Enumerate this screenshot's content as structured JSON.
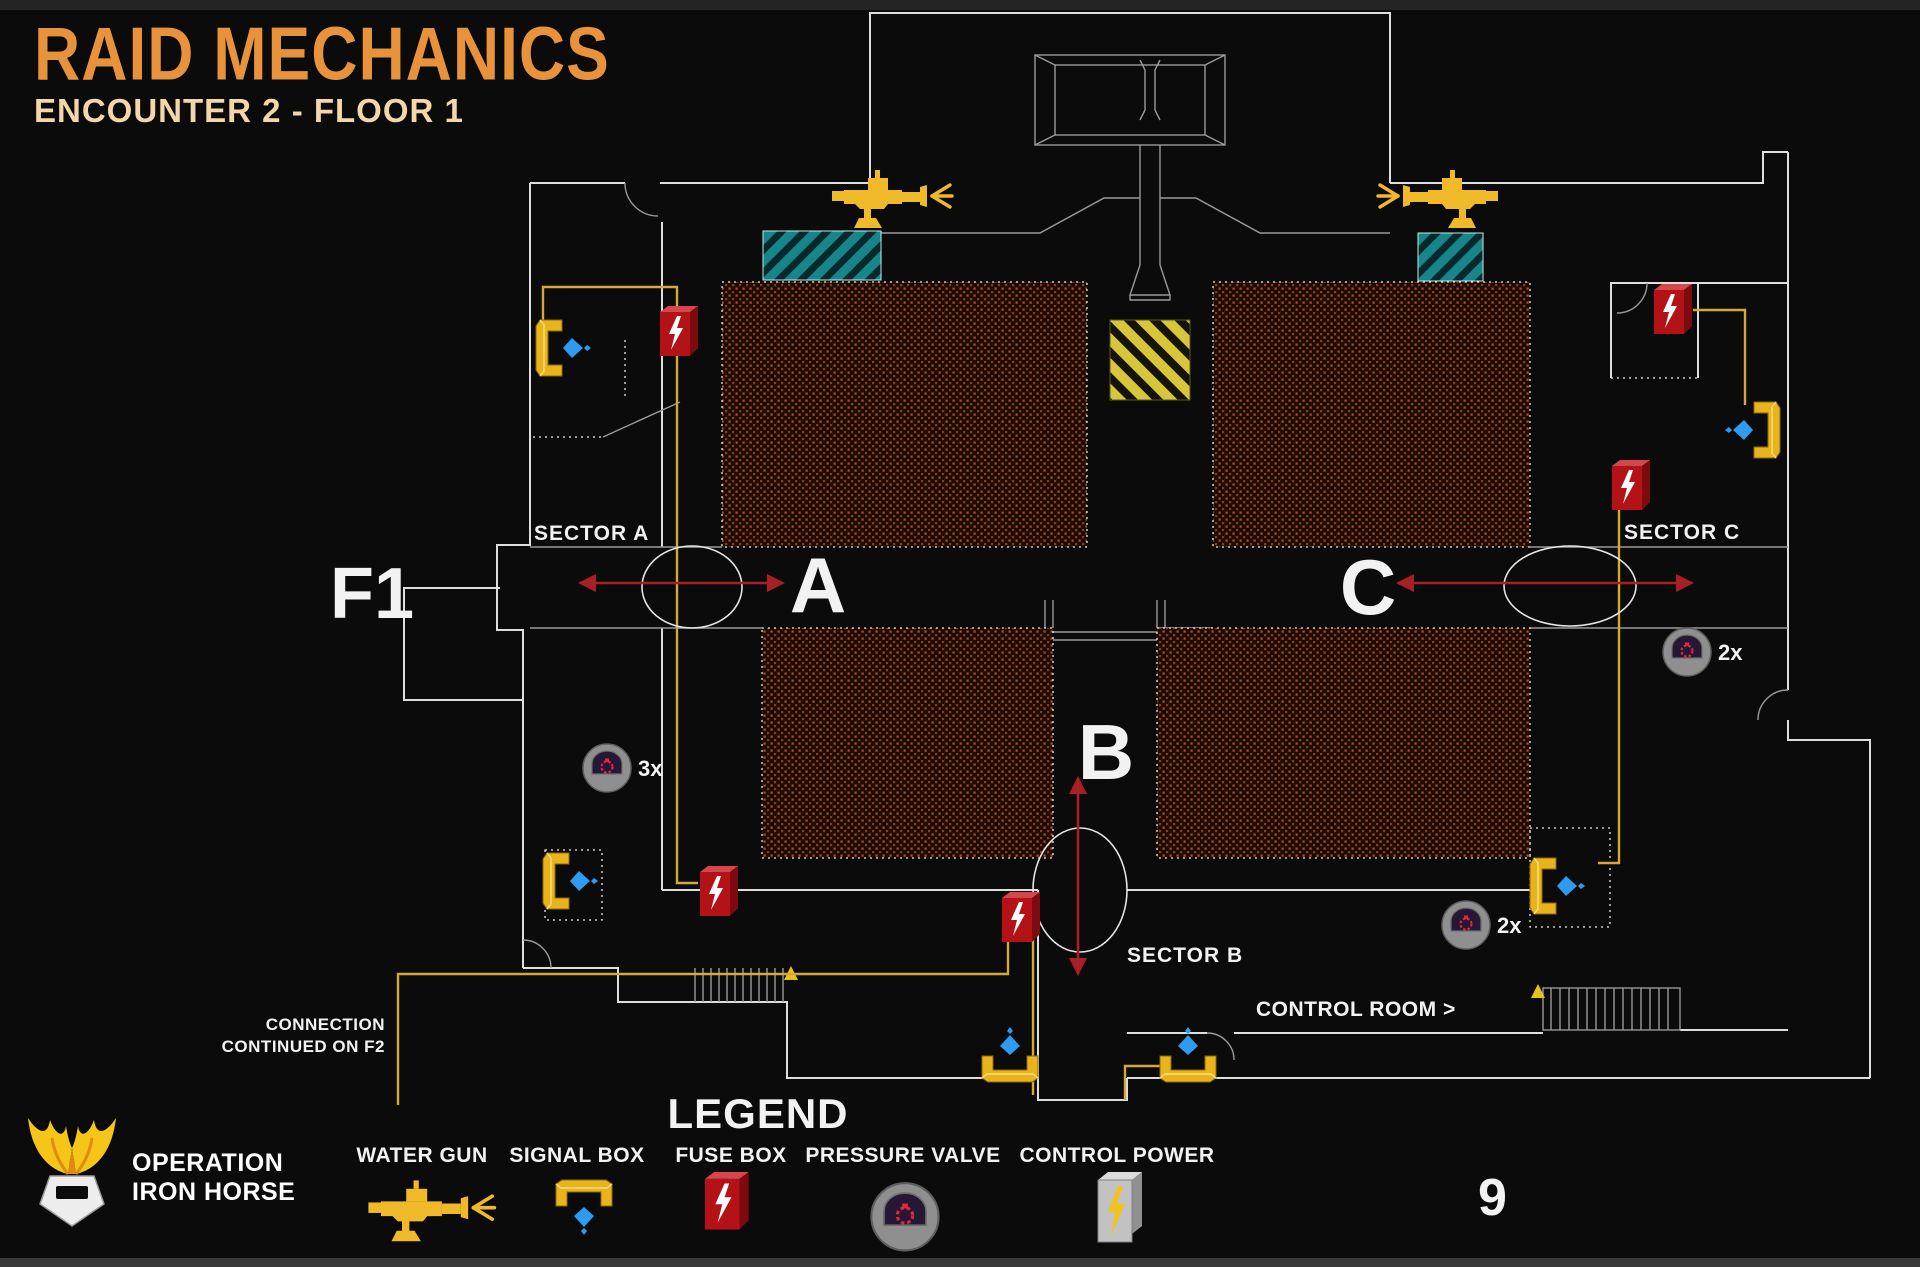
{
  "colors": {
    "background": "#0B0B0B",
    "title_orange": "#E8923B",
    "subtitle_cream": "#F4D7A8",
    "wall_white": "#DEDEDE",
    "wire_yellow": "#D4A93C",
    "fuse_red": "#B31217",
    "signal_yellow": "#E9B31B",
    "water_blue": "#2E9BF0",
    "arrow_red": "#A62025",
    "teal_hatch": "#17868B",
    "caution_yellow": "#D8C63A",
    "block_rust": "#B5521B"
  },
  "header": {
    "title": "RAID MECHANICS",
    "subtitle": "ENCOUNTER 2 - FLOOR 1"
  },
  "map": {
    "floor_label": "F1",
    "sectors": [
      {
        "letter": "A",
        "label": "SECTOR A"
      },
      {
        "letter": "B",
        "label": "SECTOR B"
      },
      {
        "letter": "C",
        "label": "SECTOR C"
      }
    ],
    "control_room_label": "CONTROL ROOM >",
    "connection_note_line1": "CONNECTION",
    "connection_note_line2": "CONTINUED ON F2",
    "marker_counts": {
      "valve_sector_a": "3x",
      "valve_sector_c": "2x",
      "valve_sector_b": "2x"
    }
  },
  "legend": {
    "title": "LEGEND",
    "items": [
      {
        "label": "WATER GUN",
        "icon": "water-gun-icon"
      },
      {
        "label": "SIGNAL BOX",
        "icon": "signal-box-icon"
      },
      {
        "label": "FUSE BOX",
        "icon": "fuse-box-icon"
      },
      {
        "label": "PRESSURE VALVE",
        "icon": "pressure-valve-icon"
      },
      {
        "label": "CONTROL POWER",
        "icon": "control-power-icon"
      }
    ]
  },
  "footer": {
    "logo_line1": "OPERATION",
    "logo_line2": "IRON HORSE",
    "page_number": "9"
  }
}
